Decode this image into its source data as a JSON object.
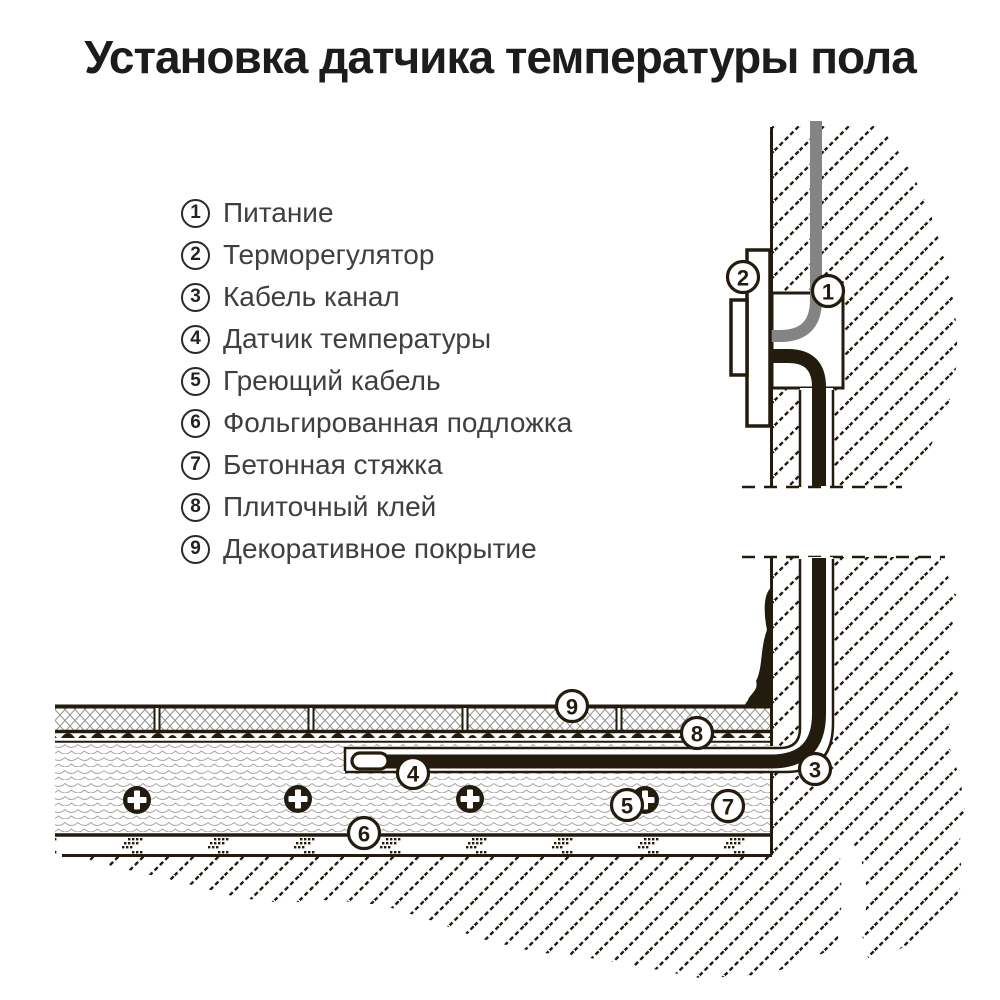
{
  "title": "Установка датчика температуры пола",
  "legend": {
    "items": [
      {
        "num": "1",
        "label": "Питание"
      },
      {
        "num": "2",
        "label": "Терморегулятор"
      },
      {
        "num": "3",
        "label": "Кабель канал"
      },
      {
        "num": "4",
        "label": "Датчик температуры"
      },
      {
        "num": "5",
        "label": "Греющий кабель"
      },
      {
        "num": "6",
        "label": "Фольгированная подложка"
      },
      {
        "num": "7",
        "label": "Бетонная стяжка"
      },
      {
        "num": "8",
        "label": "Плиточный клей"
      },
      {
        "num": "9",
        "label": "Декоративное покрытие"
      }
    ]
  },
  "callouts": [
    {
      "num": "1"
    },
    {
      "num": "2"
    },
    {
      "num": "3"
    },
    {
      "num": "4"
    },
    {
      "num": "5"
    },
    {
      "num": "6"
    },
    {
      "num": "7"
    },
    {
      "num": "8"
    },
    {
      "num": "9"
    }
  ],
  "colors": {
    "ink": "#231b0e",
    "power_cable_gray": "#848484",
    "background": "#ffffff",
    "pattern_gray": "#9a9a9a"
  }
}
